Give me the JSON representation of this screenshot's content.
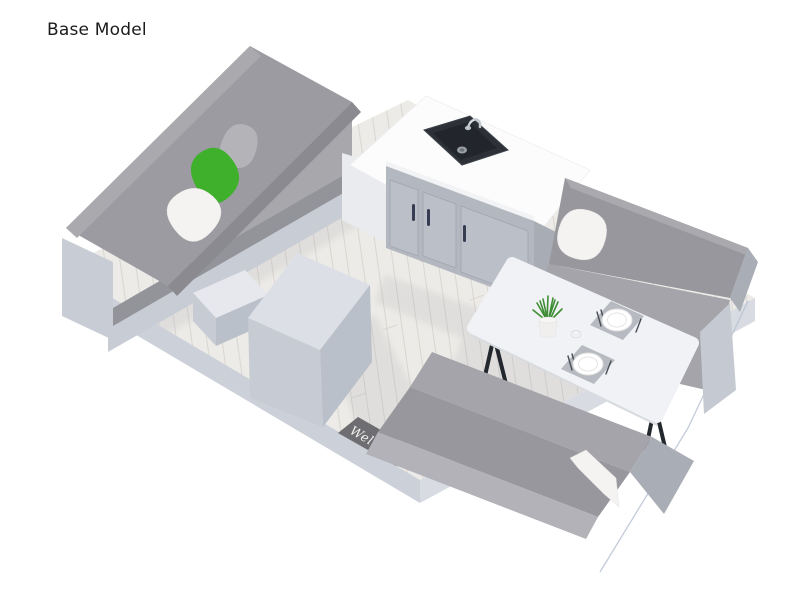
{
  "title": "Base Model",
  "scene": {
    "description": "3D isometric interior rendering of a camper floor plan",
    "mat_text": "Welcome",
    "objects": [
      "gray sofa with green and white pillows",
      "white storage cube",
      "kitchen cabinet with three doors",
      "black sink with chrome faucet on white counter",
      "white dining table with two place settings and potted plant",
      "two gray dinette benches with white pillow",
      "welcome door mat",
      "light wood plank floor"
    ]
  },
  "colors": {
    "background": "#ffffff",
    "title_text": "#1b1b1b",
    "floor": "#edebe7",
    "plank_line": "#d9d6d1",
    "platform_side": "#ccd0d8",
    "platform_side_right": "#d8dbe2",
    "platform_outline": "#b9c2d2",
    "sofa_backrest": "#9b9ba1",
    "sofa_backrest_bevel": "#a9a9ae",
    "sofa_backrest_end": "#8a8a90",
    "sofa_seat": "#a7a7ac",
    "sofa_seat_face": "#93939a",
    "sofa_base": "#c8ccd4",
    "pillow_gray": "#b4b4b8",
    "pillow_green": "#3fb02b",
    "pillow_white": "#f4f3f1",
    "slab_white": "#e6e8ed",
    "cube_top": "#dcdfe6",
    "cube_left": "#c7cbd3",
    "cube_right": "#bac0c9",
    "cabinet_panel": "#eaebee",
    "counter_white": "#fcfcfd",
    "counter_edge": "#f2f3f5",
    "cabinet_face": "#b3b7bf",
    "cabinet_door": "#bbbfc7",
    "cabinet_side": "#a8acb4",
    "handle_dark": "#363c52",
    "sink_body": "#2d3137",
    "sink_bowl": "#22262c",
    "sink_drain": "#9aa0a8",
    "faucet_chrome": "#c3c8d0",
    "bench_backrest": "#97979d",
    "bench_seat": "#a4a4aa",
    "bench_end": "#a9adb5",
    "bench_front": "#b2b2b8",
    "bench_base": "#c5c9d1",
    "table_top": "#f1f2f5",
    "table_edge": "#d8dbdf",
    "table_leg": "#23272e",
    "plant_green": "#3e8d33",
    "plant_pot": "#f0efed",
    "placemat": "#b7bac0",
    "plate": "#ffffff",
    "cutlery": "#4a4f57",
    "mat_dark": "#6e6d71",
    "mat_text_color": "#f2f1ef",
    "shadow": "#8a8e9a"
  }
}
